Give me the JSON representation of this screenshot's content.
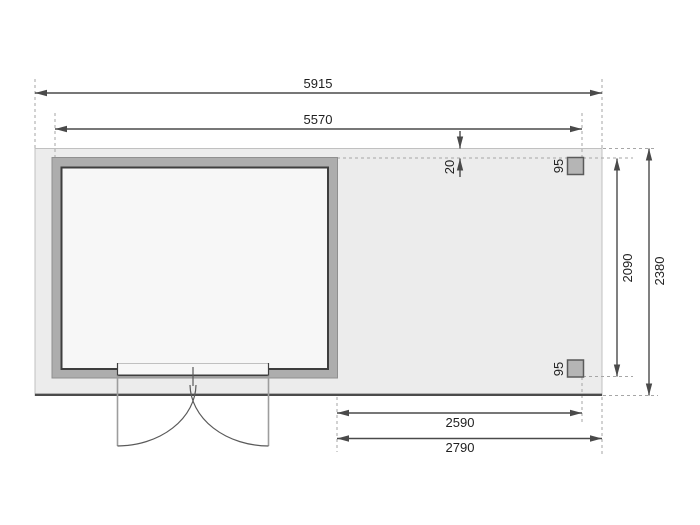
{
  "dimensions": {
    "total_width": "5915",
    "house_width": "5570",
    "offset_top": "20",
    "post_top": "95",
    "post_bottom": "95",
    "side_depth_inner": "2090",
    "total_depth": "2380",
    "annex_width_inner": "2590",
    "annex_width_outer": "2790"
  },
  "colors": {
    "background": "#ffffff",
    "floor_fill": "#ececec",
    "floor_edge": "#c0c0c0",
    "floor_bottom_edge": "#4b4b4b",
    "wall_fill": "#adadad",
    "wall_edge": "#8f8f8f",
    "interior_fill": "#f7f7f7",
    "interior_outline": "#3e3e3e",
    "door_line": "#9d9d9d",
    "arc_line": "#5a5a5a",
    "post_fill": "#b5b5b5",
    "post_outline": "#5a5a5a",
    "dim_line": "#4a4a4a",
    "dash_line": "#a6a6a6",
    "text": "#1f1f1f"
  }
}
